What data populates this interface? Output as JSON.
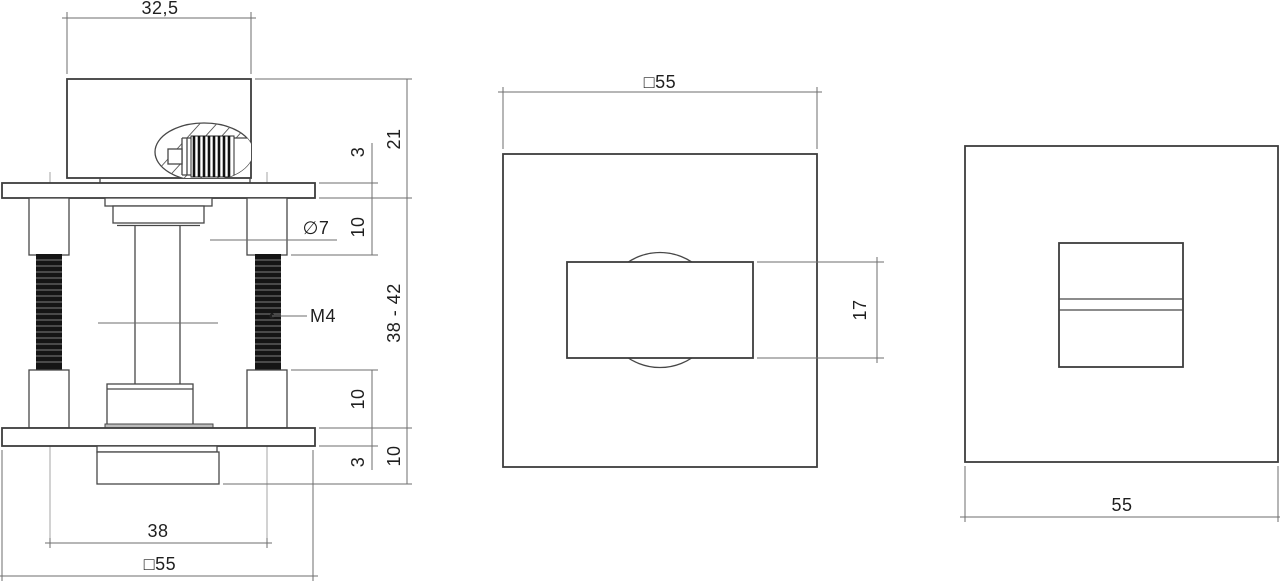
{
  "drawing": {
    "type": "technical-drawing",
    "background": "#ffffff",
    "line_color": "#3d3d3d",
    "dim_line_color": "#6e6e6e",
    "text_color": "#1f1f1f",
    "views": {
      "side": {
        "labels": {
          "knob_width": "32,5",
          "protrusion_height": "21",
          "top_plate_thickness": "3",
          "upper_post_length": "10",
          "post_diameter": "∅7",
          "spindle_size": "□8",
          "thread_size": "M4",
          "adjust_range": "38 - 42",
          "lower_post_length": "10",
          "back_knob_depth": "10",
          "bottom_plate_thickness": "3",
          "screw_distance": "38",
          "rosette_size": "□55"
        }
      },
      "front": {
        "labels": {
          "rosette_size": "□55",
          "turn_knob_height": "17"
        }
      },
      "back": {
        "labels": {
          "rosette_size": "55"
        }
      }
    }
  }
}
